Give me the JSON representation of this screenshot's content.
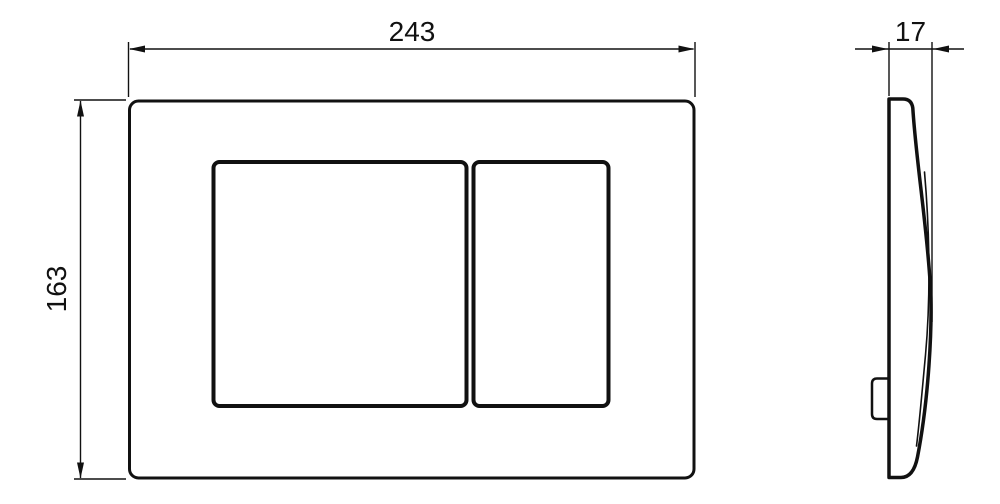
{
  "drawing": {
    "type": "technical-dimension-drawing",
    "subject": "flush plate with two rectangular buttons, front view and side profile view",
    "background_color": "#ffffff",
    "line_color": "#111111"
  },
  "dimensions": {
    "width": {
      "label": "243",
      "applies_to": "front view overall width"
    },
    "height": {
      "label": "163",
      "applies_to": "front view overall height"
    },
    "depth": {
      "label": "17",
      "applies_to": "side view overall depth"
    }
  }
}
